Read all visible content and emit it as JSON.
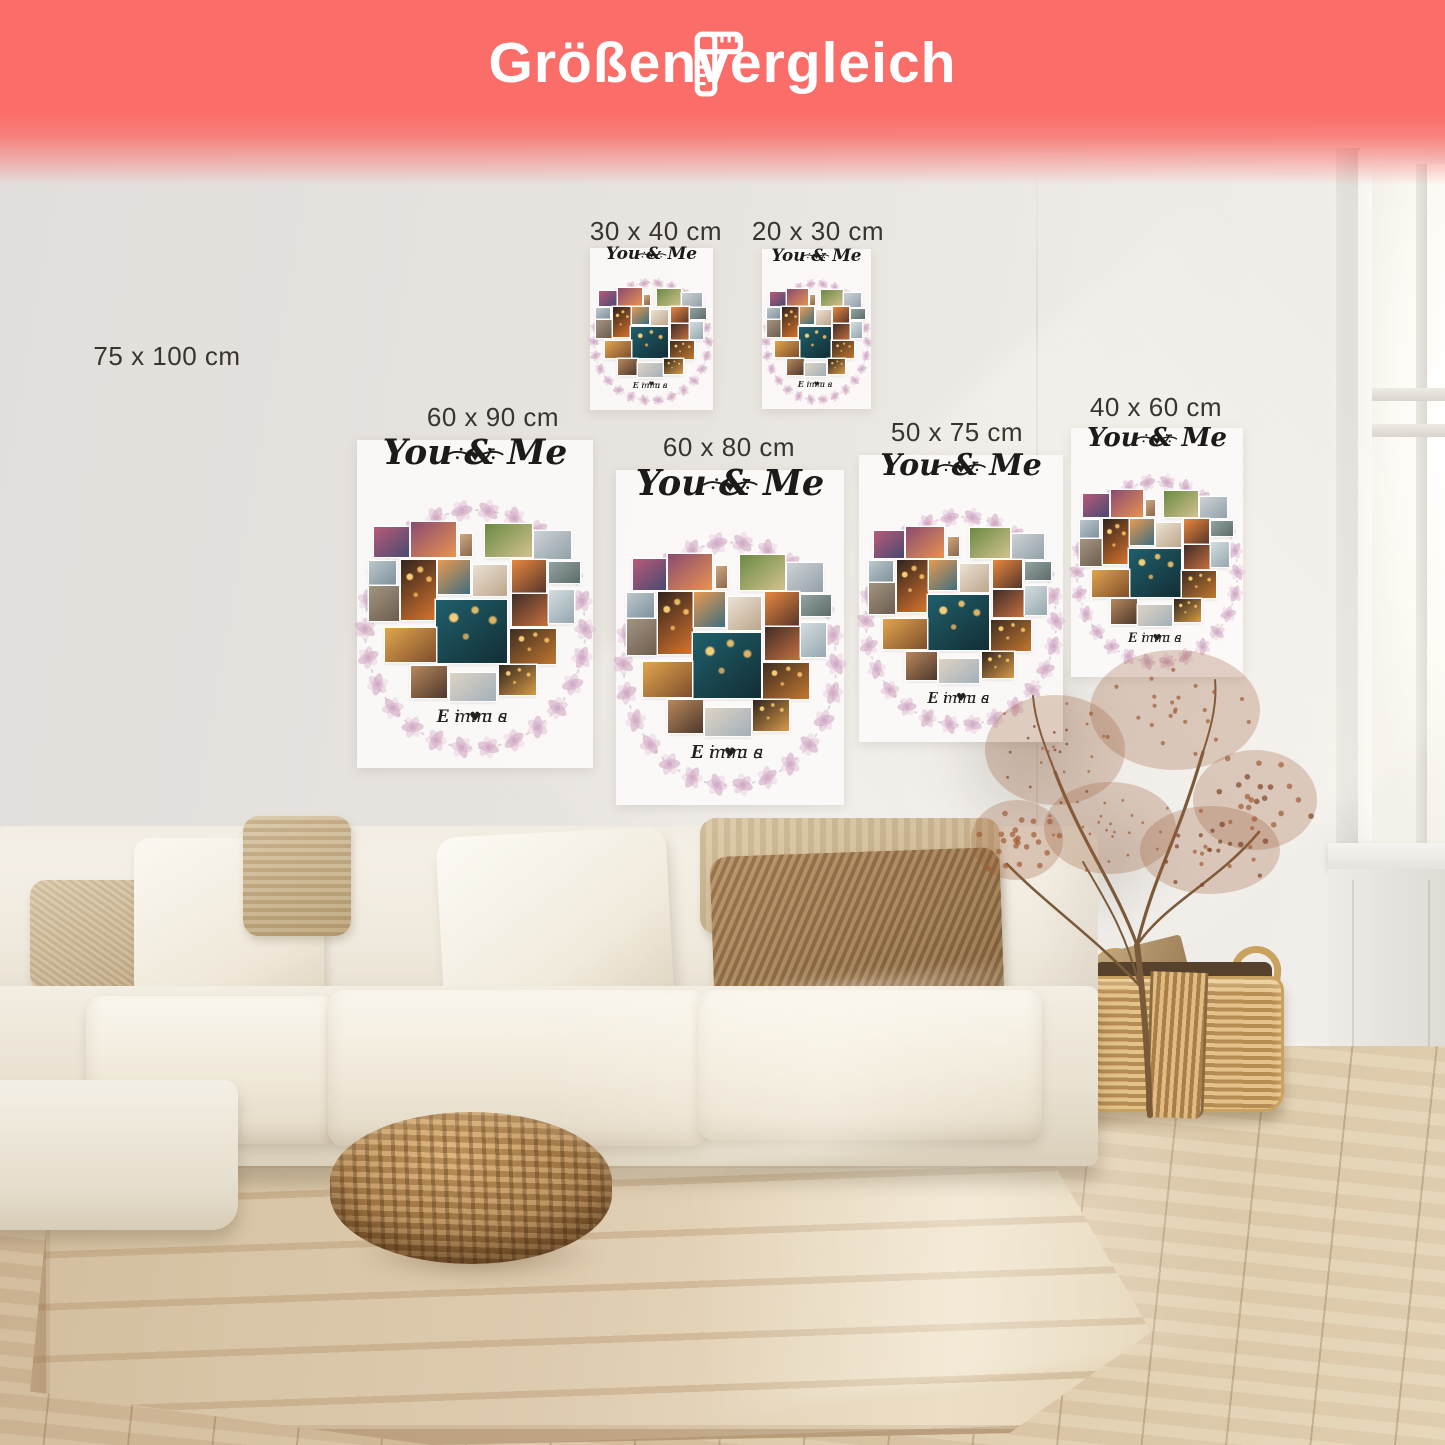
{
  "banner": {
    "title": "Größenvergleich",
    "icon": "ruler-icon",
    "background": "#fb6d69",
    "text_color": "#ffffff"
  },
  "size_labels": [
    {
      "id": "75x100",
      "text": "75 x 100 cm"
    },
    {
      "id": "30x40",
      "text": "30 x 40 cm"
    },
    {
      "id": "20x30",
      "text": "20 x 30 cm"
    },
    {
      "id": "60x90",
      "text": "60 x 90 cm"
    },
    {
      "id": "60x80",
      "text": "60 x 80 cm"
    },
    {
      "id": "50x75",
      "text": "50 x 75 cm"
    },
    {
      "id": "40x60",
      "text": "40 x 60 cm"
    }
  ],
  "labels_color": "#38342e",
  "poster": {
    "title": "You & Me",
    "title_heart": "♥",
    "name_left": "Linus",
    "name_separator": "♥",
    "name_right": "Emma",
    "background": "rgba(252,250,248,0.92)",
    "wreath_color": "#dfc0d3",
    "wreath_color_dark": "#cda3bf",
    "text_color": "#1d1b19",
    "photo_tiles": [
      {
        "name": "party-pink-photo",
        "from": "#b85a77",
        "to": "#4a4a72"
      },
      {
        "name": "palm-party-photo",
        "from": "#8a4a72",
        "to": "#e8944f"
      },
      {
        "name": "portrait-photo",
        "from": "#cfa87e",
        "to": "#8a684e"
      },
      {
        "name": "garden-party-photo",
        "from": "#6a8a42",
        "to": "#d2c28f"
      },
      {
        "name": "beach-group-photo",
        "from": "#cdd2d6",
        "to": "#93a0a8"
      },
      {
        "name": "couple-walk-photo",
        "from": "#bcc8cd",
        "to": "#7e909a"
      },
      {
        "name": "elephants-photo",
        "from": "#a39482",
        "to": "#6d5d4e"
      },
      {
        "name": "campfire-photo",
        "from": "#31241c",
        "to": "#d8742e",
        "lights": true
      },
      {
        "name": "palm-sunset-photo",
        "from": "#e89a52",
        "to": "#3f6e7e"
      },
      {
        "name": "wedding-group-photo",
        "from": "#ece1d3",
        "to": "#bca68c"
      },
      {
        "name": "ocean-sunset-photo",
        "from": "#e8883e",
        "to": "#57352a"
      },
      {
        "name": "friends-group-photo",
        "from": "#93a3a2",
        "to": "#5d6c6b"
      },
      {
        "name": "silhouettes-photo",
        "from": "#3e2c28",
        "to": "#c7703e"
      },
      {
        "name": "couple-beach-photo",
        "from": "#d3dde1",
        "to": "#97a7af"
      },
      {
        "name": "party-lights-photo",
        "from": "#1f5f6b",
        "to": "#132e35",
        "lights": true
      },
      {
        "name": "golden-field-photo",
        "from": "#e2a54e",
        "to": "#7e4e2c"
      },
      {
        "name": "fire-dinner-photo",
        "from": "#3e2d22",
        "to": "#c2772e",
        "lights": true
      },
      {
        "name": "dinner-friends-photo",
        "from": "#b8885c",
        "to": "#4e382c"
      },
      {
        "name": "family-beach-photo",
        "from": "#ded3c4",
        "to": "#a3b0ba"
      },
      {
        "name": "lanterns-photo",
        "from": "#2e241b",
        "to": "#d89b4a",
        "lights": true
      }
    ]
  },
  "colors": {
    "wall": "#e2dedb",
    "floor": "#d8c2a2",
    "rug": "#decbaf",
    "sofa": "#efe9dd",
    "pillow_beige": "#dcc9a9",
    "pillow_brown": "#b08a5e",
    "pouf": "#b1854f",
    "basket": "#d3ab6d",
    "plant": "#9a5f38",
    "window_light": "#fdfbf5"
  }
}
